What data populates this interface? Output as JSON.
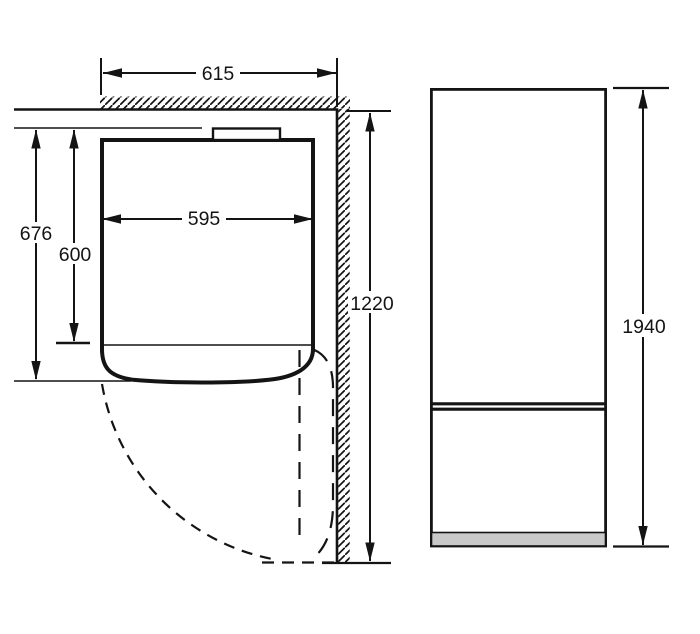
{
  "diagram_type": "appliance-installation-dimensions",
  "views": {
    "top": {
      "niche_width": "615",
      "appliance_width": "595",
      "depth_with_clearance": "676",
      "appliance_depth": "600",
      "side_wall_length": "1220"
    },
    "front": {
      "appliance_height": "1940"
    }
  },
  "colors": {
    "line": "#141414",
    "plinth": "#c9c9c9",
    "background": "#ffffff"
  }
}
